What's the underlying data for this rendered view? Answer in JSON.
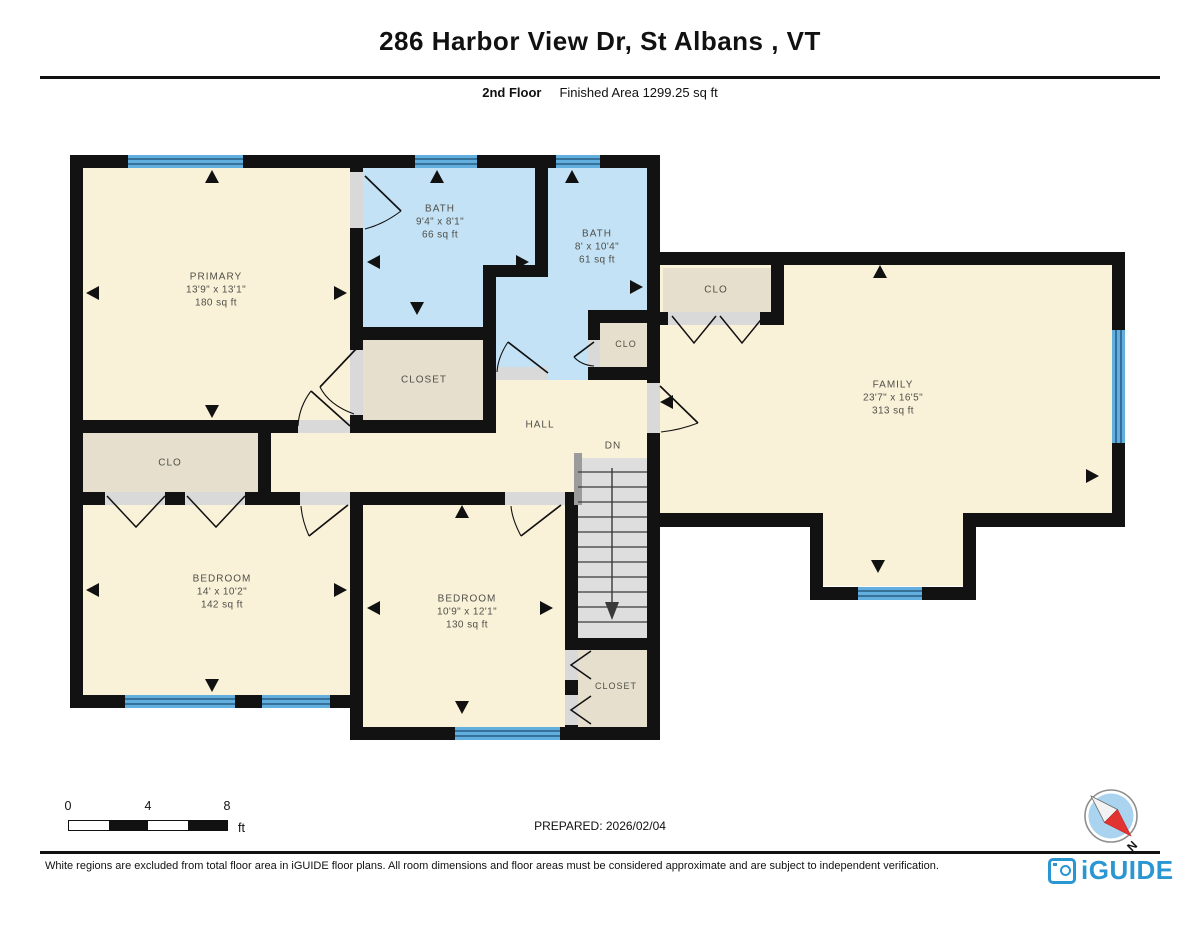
{
  "header": {
    "title": "286 Harbor View Dr, St Albans , VT",
    "floor_label": "2nd Floor",
    "finished_area_label": "Finished Area 1299.25 sq ft"
  },
  "plan": {
    "rooms": [
      {
        "id": "primary",
        "name": "PRIMARY",
        "dims": "13'9\" x 13'1\"",
        "area": "180 sq ft"
      },
      {
        "id": "bath-1",
        "name": "BATH",
        "dims": "9'4\" x 8'1\"",
        "area": "66 sq ft"
      },
      {
        "id": "bath-2",
        "name": "BATH",
        "dims": "8' x 10'4\"",
        "area": "61 sq ft"
      },
      {
        "id": "closet-hall",
        "name": "CLOSET"
      },
      {
        "id": "clo-small",
        "name": "CLO"
      },
      {
        "id": "hall",
        "name": "HALL"
      },
      {
        "id": "stairs-down",
        "name": "DN"
      },
      {
        "id": "clo-family",
        "name": "CLO"
      },
      {
        "id": "family",
        "name": "FAMILY",
        "dims": "23'7\" x 16'5\"",
        "area": "313 sq ft"
      },
      {
        "id": "clo-left",
        "name": "CLO"
      },
      {
        "id": "bedroom-1",
        "name": "BEDROOM",
        "dims": "14' x 10'2\"",
        "area": "142 sq ft"
      },
      {
        "id": "bedroom-2",
        "name": "BEDROOM",
        "dims": "10'9\" x 12'1\"",
        "area": "130 sq ft"
      },
      {
        "id": "closet-bedroom2",
        "name": "CLOSET"
      }
    ]
  },
  "scale_bar": {
    "ticks": [
      "0",
      "4",
      "8"
    ],
    "unit": "ft"
  },
  "prepared_label": "PREPARED: 2026/02/04",
  "compass": {
    "north_label": "N"
  },
  "footer": {
    "disclaimer": "White regions are excluded from total floor area in iGUIDE floor plans. All room dimensions and floor areas must be considered approximate and are subject to independent verification.",
    "brand": "iGUIDE"
  },
  "colors": {
    "wall": "#121212",
    "room_cream": "#faf2d8",
    "bath_blue": "#c3e2f5",
    "closet_tan": "#e6dfcd",
    "stairs_gray": "#dedede",
    "window_blue": "#62aede",
    "window_line": "#1d4d72",
    "brand_blue": "#2a96d2"
  }
}
